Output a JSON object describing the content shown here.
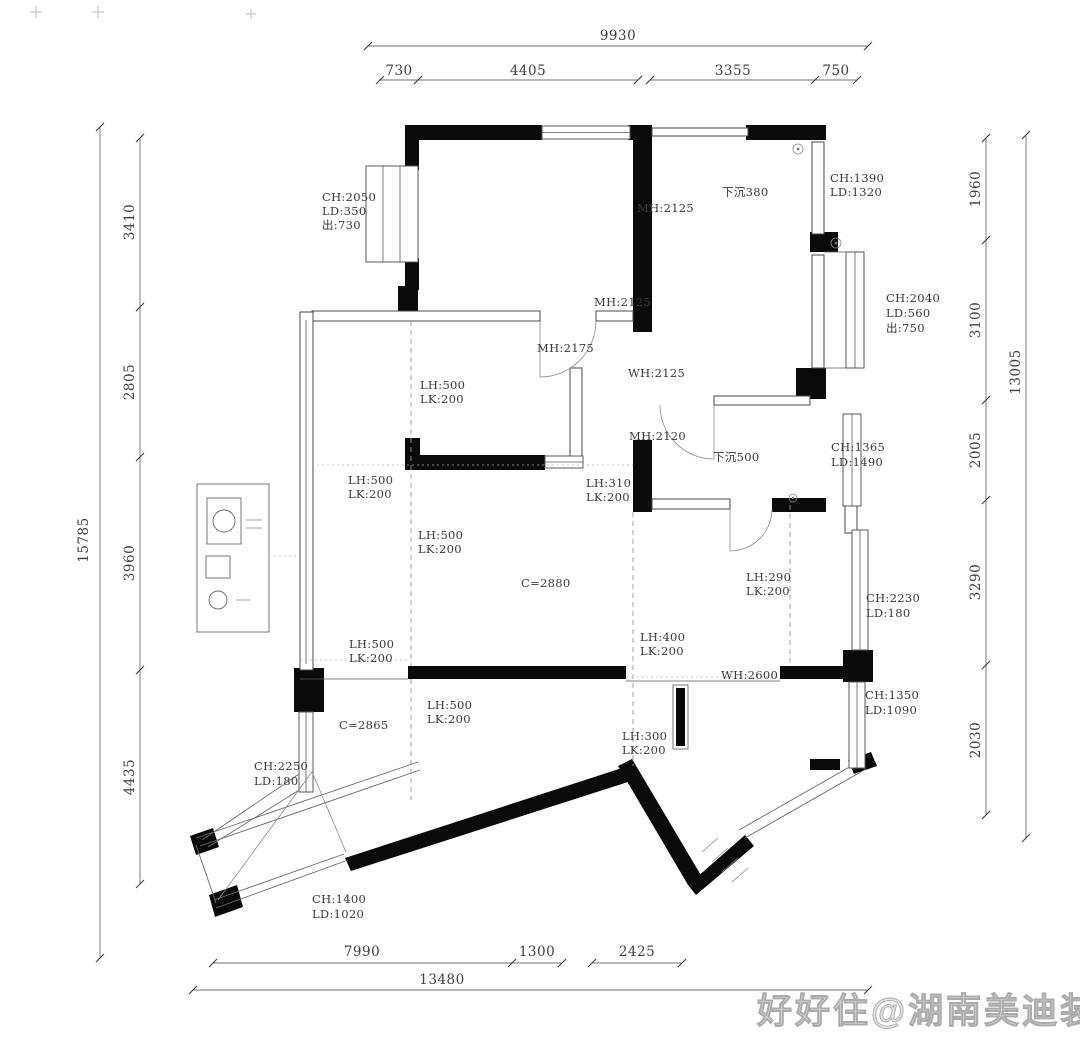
{
  "watermark": "好好住@湖南美迪装饰",
  "dimensions": {
    "top": {
      "overall": "9930",
      "segments": [
        "730",
        "4405",
        "3355",
        "750"
      ]
    },
    "left": {
      "overall": "15785",
      "segments": [
        "3410",
        "2805",
        "3960",
        "4435"
      ]
    },
    "right": {
      "overall": "13005",
      "segments": [
        "1960",
        "3100",
        "2005",
        "3290",
        "2030"
      ]
    },
    "bottom": {
      "overall": "13480",
      "segments": [
        "7990",
        "1300",
        "2425"
      ]
    }
  },
  "annotations": {
    "bay_window_top_left": [
      "CH:2050",
      "LD:350",
      "出:730"
    ],
    "door_height_top": "MH:2125",
    "sunken_area_top": "下沉380",
    "window_top_right": [
      "CH:1390",
      "LD:1320"
    ],
    "door_height_mid_top": "MH:2125",
    "door_height_mid_left": "MH:2175",
    "window_height_mid": "WH:2125",
    "bay_window_right": [
      "CH:2040",
      "LD:560",
      "出:750"
    ],
    "door_height_mid_low": "MH:2120",
    "sunken_area_mid": "下沉500",
    "window_right_mid": [
      "CH:1365",
      "LD:1490"
    ],
    "beam_bedroom_left": [
      "LH:500",
      "LK:200"
    ],
    "beam_left_wall": [
      "LH:500",
      "LK:200"
    ],
    "beam_corridor": [
      "LH:310",
      "LK:200"
    ],
    "beam_living_top": [
      "LH:500",
      "LK:200"
    ],
    "ceiling_living": "C=2880",
    "beam_right": [
      "LH:290",
      "LK:200"
    ],
    "window_right_low": [
      "CH:2230",
      "LD:180"
    ],
    "beam_left_lower": [
      "LH:500",
      "LK:200"
    ],
    "beam_living_bottom": [
      "LH:400",
      "LK:200"
    ],
    "window_width_bottom": "WH:2600",
    "window_right_bottom": [
      "CH:1350",
      "LD:1090"
    ],
    "beam_dining": [
      "LH:500",
      "LK:200"
    ],
    "ceiling_dining": "C=2865",
    "beam_entry": [
      "LH:300",
      "LK:200"
    ],
    "window_balcony_left": [
      "CH:2250",
      "LD:180"
    ],
    "window_balcony_bottom": [
      "CH:1400",
      "LD:1020"
    ]
  },
  "colors": {
    "wall": "#0a0a0a",
    "line": "#555555",
    "dim_text": "#3f3f3f",
    "watermark": "#c9c9c9"
  }
}
